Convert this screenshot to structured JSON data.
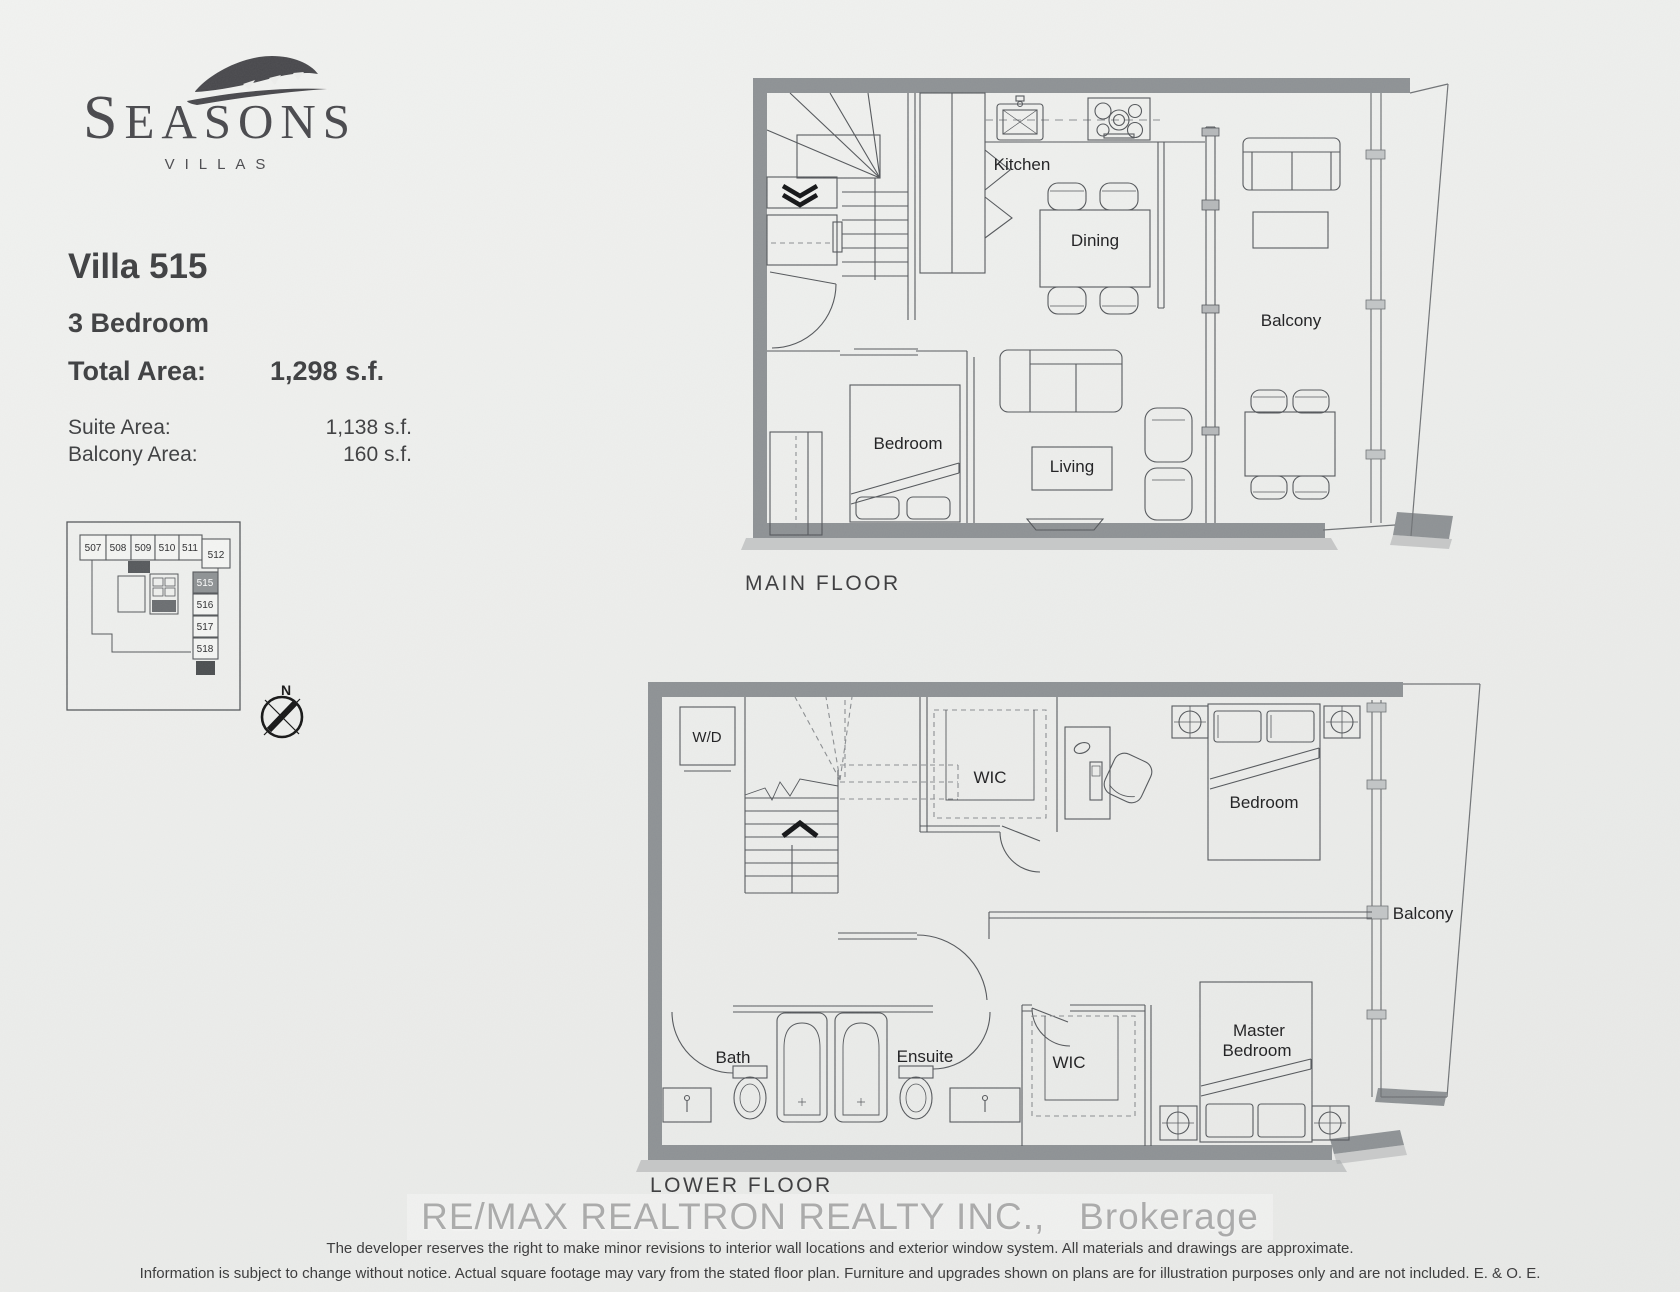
{
  "logo": {
    "name": "SEASONS",
    "sub": "VILLAS"
  },
  "unit": {
    "title": "Villa 515",
    "type": "3 Bedroom",
    "total_area_label": "Total Area:",
    "total_area_value": "1,298 s.f.",
    "suite_area_label": "Suite Area:",
    "suite_area_value": "1,138 s.f.",
    "balcony_area_label": "Balcony Area:",
    "balcony_area_value": "160 s.f."
  },
  "keyplan": {
    "top_units": [
      "507",
      "508",
      "509",
      "510",
      "511",
      "512"
    ],
    "side_units": [
      "515",
      "516",
      "517",
      "518"
    ],
    "highlighted_unit": "515"
  },
  "compass": {
    "north_label": "N"
  },
  "main_floor": {
    "caption": "MAIN FLOOR",
    "rooms": {
      "kitchen": "Kitchen",
      "dining": "Dining",
      "balcony": "Balcony",
      "bedroom": "Bedroom",
      "living": "Living"
    }
  },
  "lower_floor": {
    "caption": "LOWER FLOOR",
    "rooms": {
      "wd": "W/D",
      "wic_upper": "WIC",
      "bedroom": "Bedroom",
      "balcony": "Balcony",
      "bath": "Bath",
      "ensuite": "Ensuite",
      "wic_lower": "WIC",
      "master_line1": "Master",
      "master_line2": "Bedroom"
    }
  },
  "footer": {
    "watermark": "RE/MAX REALTRON REALTY INC.,   Brokerage",
    "disclaimer_line1": "The developer reserves the right to make minor revisions to interior wall locations and exterior window system. All materials and drawings are approximate.",
    "disclaimer_line2": "Information is subject to change without notice. Actual square footage may vary from the stated floor plan. Furniture and upgrades shown on plans are for illustration purposes only and are not included. E. & O. E."
  },
  "icons": {
    "logo_leaf": "leaf-icon",
    "compass": "compass-rose-icon"
  },
  "colors": {
    "paper": "#edeeec",
    "wall_gray": "#8d9194",
    "line": "#53565a",
    "text_dark": "#3c3d3f",
    "logo_gray": "#47474b",
    "unit_highlight": "#8e9294",
    "watermark": "#9b9b9b"
  }
}
